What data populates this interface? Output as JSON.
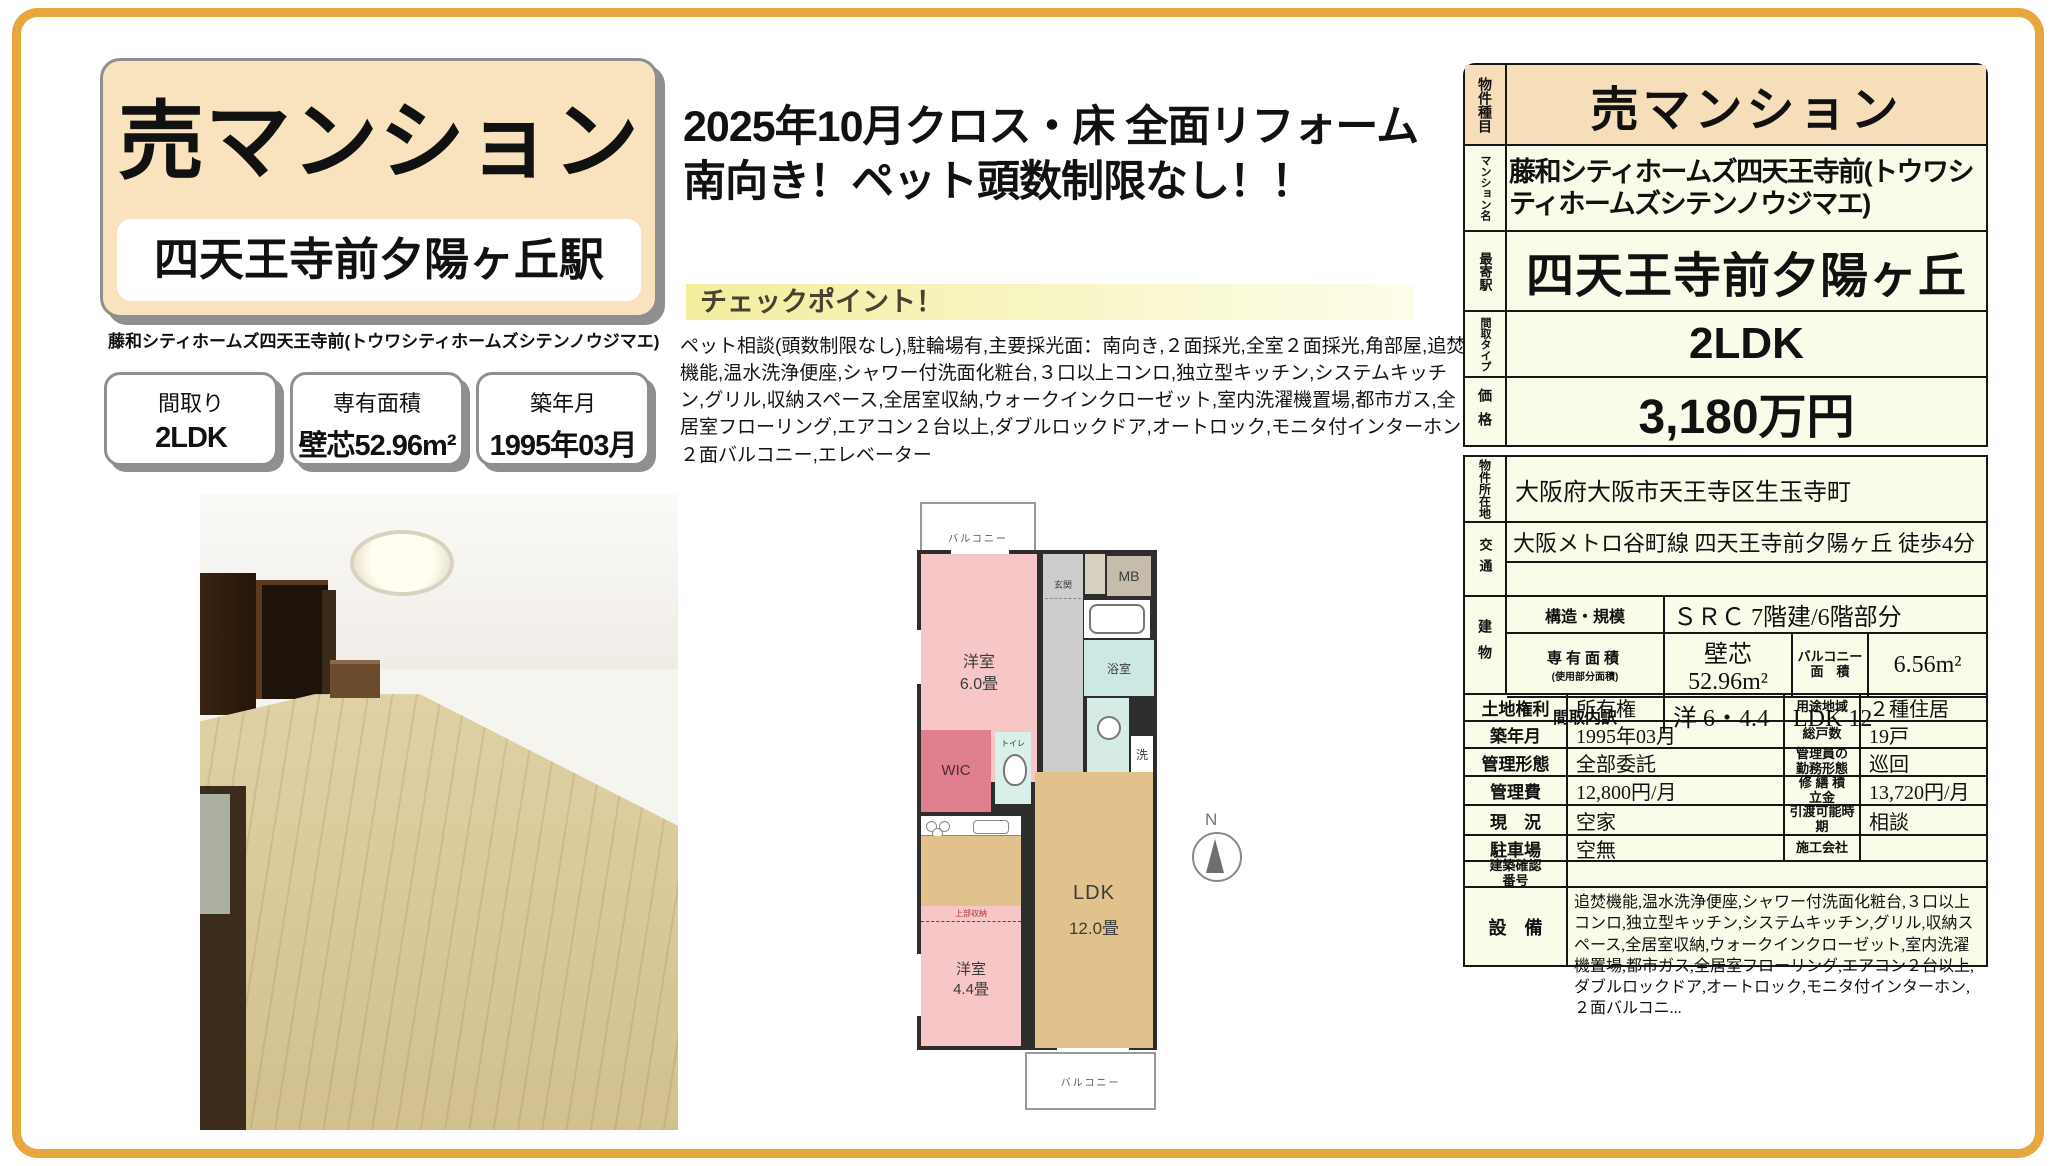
{
  "left": {
    "title": "売マンション",
    "station": "四天王寺前夕陽ヶ丘駅",
    "subtitle": "藤和シティホームズ四天王寺前(トウワシティホームズシテンノウジマエ)",
    "badges": [
      {
        "label": "間取り",
        "value": "2LDK"
      },
      {
        "label": "専有面積",
        "value": "壁芯52.96m²"
      },
      {
        "label": "築年月",
        "value": "1995年03月"
      }
    ]
  },
  "center": {
    "catch1": "2025年10月クロス・床 全面リフォーム",
    "catch2": "南向き！ペット頭数制限なし！！",
    "checkpoint_title": "チェックポイント！",
    "checkpoint_body": "ペット相談(頭数制限なし),駐輪場有,主要採光面：南向き,２面採光,全室２面採光,角部屋,追焚機能,温水洗浄便座,シャワー付洗面化粧台,３口以上コンロ,独立型キッチン,システムキッチン,グリル,収納スペース,全居室収納,ウォークインクローゼット,室内洗濯機置場,都市ガス,全居室フローリング,エアコン２台以上,ダブルロックドア,オートロック,モニタ付インターホン,２面バルコニー,エレベーター"
  },
  "floorplan": {
    "balcony_top": "バルコニー",
    "entrance": "玄関",
    "mb": "MB",
    "room1_name": "洋室",
    "room1_size": "6.0畳",
    "bath": "浴室",
    "wash": "洗",
    "wic": "WIC",
    "toilet": "トイレ",
    "storage": "収納",
    "ps": "PS",
    "ldk_name": "LDK",
    "ldk_size": "12.0畳",
    "upper_storage": "上部収納",
    "room2_name": "洋室",
    "room2_size": "4.4畳",
    "balcony_bottom": "バルコニー",
    "compass": "N"
  },
  "t1": {
    "r1_label": "物件種目",
    "r1_value": "売マンション",
    "r2_label": "マンション名",
    "r2_value": "藤和シティホームズ四天王寺前(トウワシティホームズシテンノウジマエ)",
    "r3_label": "最寄駅",
    "r3_value": "四天王寺前夕陽ヶ丘",
    "r4_label": "間取タイプ",
    "r4_value": "2LDK",
    "r5_label": "価格",
    "r5_value": "3,180万円"
  },
  "t2": {
    "address_label": "物件所在地",
    "address": "大阪府大阪市天王寺区生玉寺町",
    "access_label": "交通",
    "access": "大阪メトロ谷町線 四天王寺前夕陽ヶ丘 徒歩4分",
    "bldg_label": "建物",
    "structure_label": "構造・規模",
    "structure": "ＳＲＣ 7階建/6階部分",
    "area_label": "専有面積",
    "area_label_sub": "(使用部分面積)",
    "area": "壁芯52.96m²",
    "balcony_label1": "バルコニー",
    "balcony_label2": "面　積",
    "balcony_area": "6.56m²",
    "madori_label": "間取内訳",
    "madori": "洋 6・4.4　LDK 12",
    "rows": [
      {
        "l1": "土地権利",
        "v1": "所有権",
        "l2": "用途地域",
        "v2": "２種住居"
      },
      {
        "l1": "築年月",
        "v1": "1995年03月",
        "l2": "総戸数",
        "v2": "19戸"
      },
      {
        "l1": "管理形態",
        "v1": "全部委託",
        "l2": "管理員の勤務形態",
        "v2": "巡回"
      },
      {
        "l1": "管理費",
        "v1": "12,800円/月",
        "l2": "修 繕 積立金",
        "v2": "13,720円/月"
      },
      {
        "l1": "現　況",
        "v1": "空家",
        "l2": "引渡可能時期",
        "v2": "相談"
      },
      {
        "l1": "駐車場",
        "v1": "空無",
        "l2": "施工会社",
        "v2": ""
      }
    ],
    "kakunin_label": "建築確認番号",
    "kakunin": "",
    "setsubi_label": "設　備",
    "setsubi": "追焚機能,温水洗浄便座,シャワー付洗面化粧台,３口以上コンロ,独立型キッチン,システムキッチン,グリル,収納スペース,全居室収納,ウォークインクローゼット,室内洗濯機置場,都市ガス,全居室フローリング,エアコン２台以上,ダブルロックドア,オートロック,モニタ付インターホン,２面バルコニ..."
  }
}
